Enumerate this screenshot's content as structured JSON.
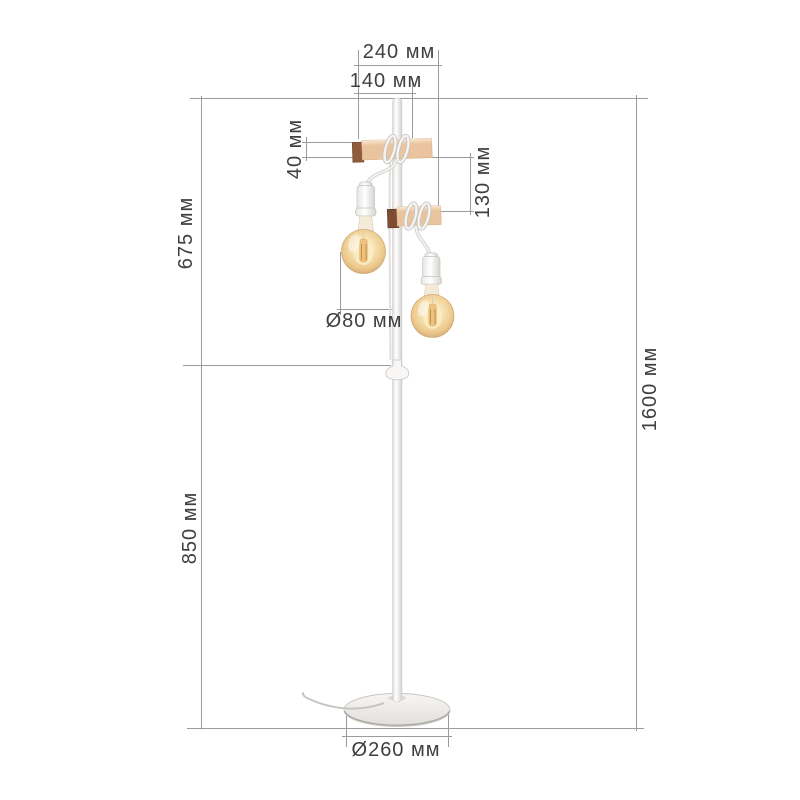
{
  "title": "Floor lamp dimension diagram",
  "unit": "мм",
  "labels": {
    "fixture_width": "240 мм",
    "upper_block_width": "140 мм",
    "block_height": "40 мм",
    "block_gap": "130 мм",
    "upper_section_height": "675 мм",
    "lower_section_height": "850 мм",
    "total_height": "1600 мм",
    "bulb_diameter": "Ø80 мм",
    "base_diameter": "Ø260 мм"
  },
  "colors": {
    "background": "#ffffff",
    "dimension_line": "#9b9b9b",
    "label_text": "#3f3f3f",
    "wood": "#eac49e",
    "wood_end_dark": "#8e5b3d",
    "bulb_glass_amber": "#eec988",
    "lamp_metal_white": "#f6f5f3"
  }
}
